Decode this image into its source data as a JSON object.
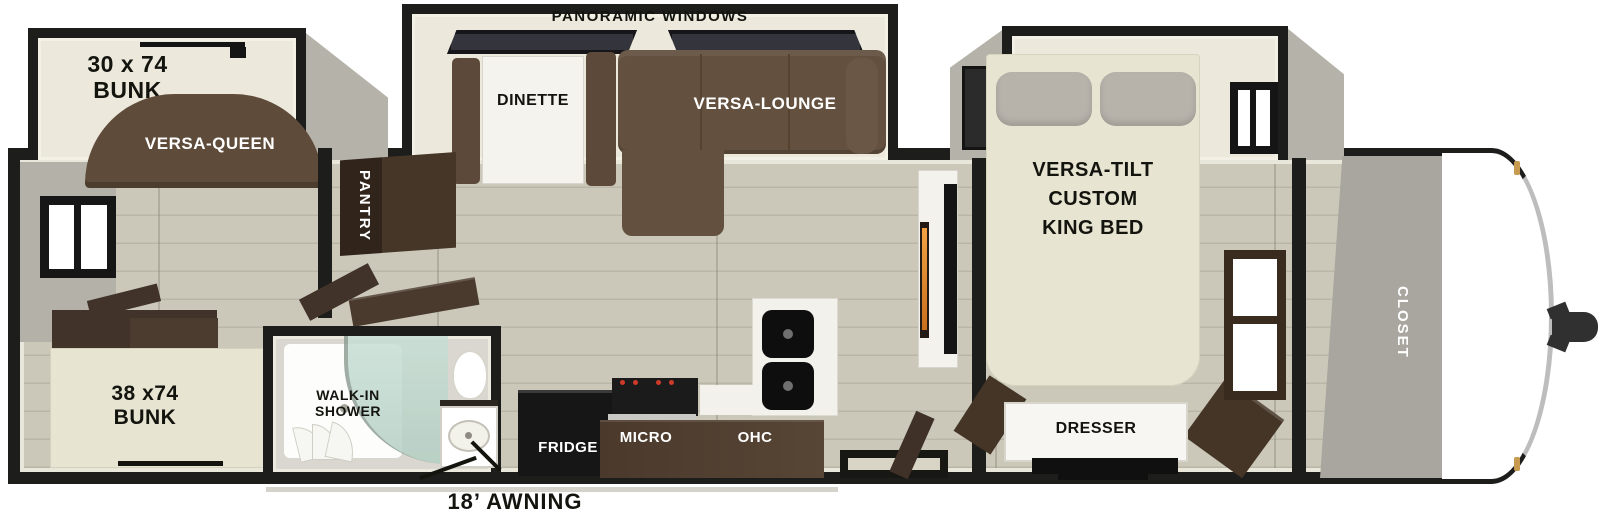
{
  "labels": {
    "panoramic": "PANORAMIC WINDOWS",
    "bunk30_l1": "30 x 74",
    "bunk30_l2": "BUNK",
    "versa_queen": "VERSA-QUEEN",
    "dinette": "DINETTE",
    "versa_lounge": "VERSA-LOUNGE",
    "pantry": "PANTRY",
    "king_l1": "VERSA-TILT",
    "king_l2": "CUSTOM",
    "king_l3": "KING BED",
    "closet": "CLOSET",
    "bunk38_l1": "38 x74",
    "bunk38_l2": "BUNK",
    "shower_l1": "WALK-IN",
    "shower_l2": "SHOWER",
    "fridge": "FRIDGE",
    "micro": "MICRO",
    "ohc": "OHC",
    "dresser": "DRESSER",
    "awning": "18’ AWNING"
  },
  "colors": {
    "wall": "#1d1d1b",
    "floor_plank": "#cbc8b9",
    "slide_floor": "#ece9dc",
    "sofa_brown": "#63503f",
    "cabinet_dark_brown": "#3c2e23",
    "counter_brown": "#4f3e30",
    "bed_beige": "#e7e4d1",
    "pillow_gray": "#b7b2aa",
    "shower_glass": "#bfd8cd",
    "fireplace_glow": "#e08518",
    "front_cap_hinge_gold": "#c79a4f",
    "appliance_black": "#161616"
  }
}
